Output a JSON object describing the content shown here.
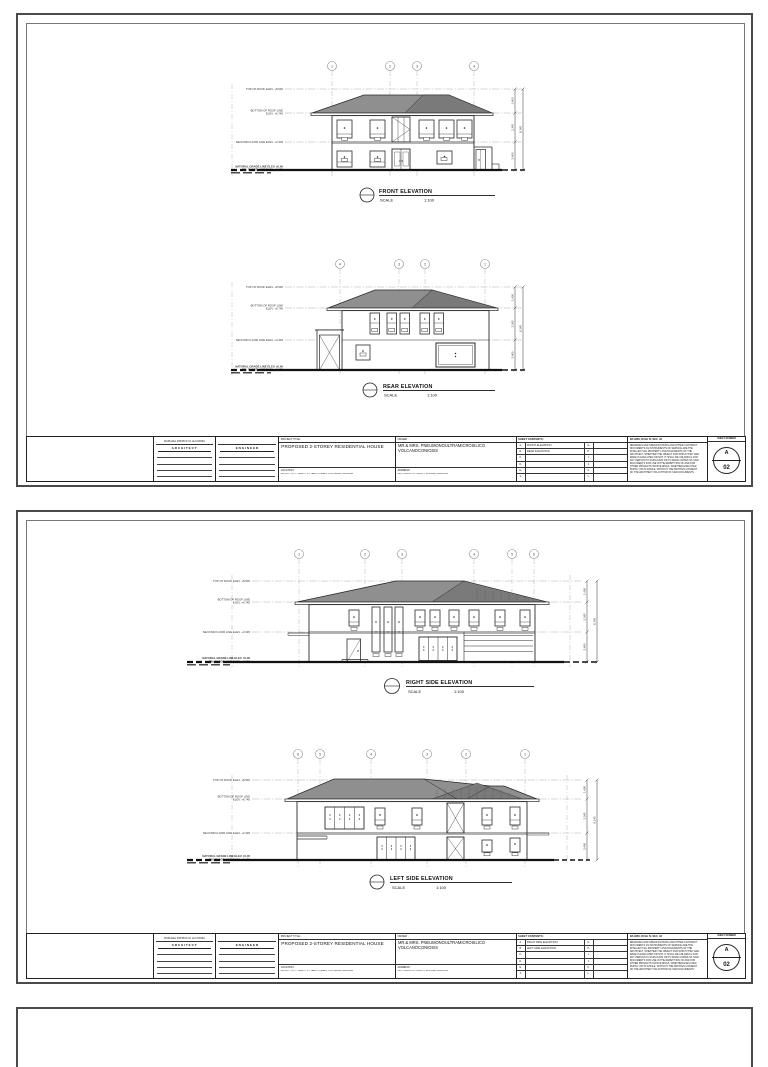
{
  "page": {
    "background": "#ffffff",
    "line_color": "#2b2b2b",
    "roof_fill": "#8f8f8f",
    "roof_fill_dark": "#7a7a7a",
    "border_color": "#4a4a4a"
  },
  "views": [
    {
      "label": "FRONT ELEVATION",
      "scale_label": "SCALE",
      "scale": "1:100",
      "bubbles": [
        "1",
        "2",
        "3",
        "4"
      ],
      "levels": [
        [
          "TOP OF ROOF ELEV. +8.545",
          ""
        ],
        [
          "BOTTOM OF ROOF LINE",
          "ELEV. +6.745"
        ],
        [
          "SECOND FLOOR LINE ELEV. +3.345",
          ""
        ],
        [
          "NATURAL GRADE LINE ELEV. ±0.00",
          "FIN. FLOOR LINE ELEV. +0.150"
        ]
      ],
      "dims": [
        "1,400",
        "3,345",
        "3,400"
      ],
      "dim_total": "8,145"
    },
    {
      "label": "REAR ELEVATION",
      "scale_label": "SCALE",
      "scale": "1:100",
      "bubbles": [
        "4",
        "3",
        "2",
        "1"
      ],
      "levels": [
        [
          "TOP OF ROOF ELEV. +8.545",
          ""
        ],
        [
          "BOTTOM OF ROOF LINE",
          "ELEV. +6.745"
        ],
        [
          "SECOND FLOOR LINE ELEV. +3.345",
          ""
        ],
        [
          "NATURAL GRADE LINE ELEV. ±0.00",
          "FIN. FLOOR LINE ELEV. +0.150"
        ]
      ],
      "dims": [
        "1,400",
        "3,345",
        "3,400"
      ],
      "dim_total": "8,145"
    },
    {
      "label": "RIGHT SIDE ELEVATION",
      "scale_label": "SCALE",
      "scale": "1:100",
      "bubbles": [
        "1",
        "2",
        "3",
        "4",
        "5",
        "6"
      ],
      "levels": [
        [
          "TOP OF ROOF ELEV. +8.545",
          ""
        ],
        [
          "BOTTOM OF ROOF LINE",
          "ELEV. +6.745"
        ],
        [
          "SECOND FLOOR LINE ELEV. +3.345",
          ""
        ],
        [
          "NATURAL GRADE LINE ELEV. ±0.00",
          "FIN. FLOOR LINE ELEV. +0.150"
        ]
      ],
      "dims": [
        "1,400",
        "3,345",
        "3,400"
      ],
      "dim_total": "8,145"
    },
    {
      "label": "LEFT SIDE ELEVATION",
      "scale_label": "SCALE",
      "scale": "1:100",
      "bubbles": [
        "6",
        "5",
        "4",
        "3",
        "2",
        "1"
      ],
      "levels": [
        [
          "TOP OF ROOF ELEV. +8.545",
          ""
        ],
        [
          "BOTTOM OF ROOF LINE",
          "ELEV. +6.745"
        ],
        [
          "SECOND FLOOR LINE ELEV. +3.345",
          ""
        ],
        [
          "NATURAL GRADE LINE ELEV. ±0.00",
          "FIN. FLOOR LINE ELEV. +0.150"
        ]
      ],
      "dims": [
        "1,400",
        "3,345",
        "3,400"
      ],
      "dim_total": "8,145"
    }
  ],
  "sheets": [
    {
      "title_block": {
        "architect_name": "RAPHAEL PATRICK M. ALCORIZA",
        "architect_label": "ARCHITECT",
        "engineer_label": "ENGINEER",
        "project_title_label": "PROJECT TITLE :",
        "project_title": "PROPOSED 2-STOREY RESIDENTIAL HOUSE",
        "location_label": "LOCATION :",
        "location": "BLOCK 7 LOT 7 EARTH ST. NEPO HOMES, STA. MARIA, BULACAN",
        "owner_label": "OWNER :",
        "owner": "MR.& MRS. PNEUMONOULTRAMICROSILICO VOLCANOCONIOSIS",
        "address_label": "ADDRESS :",
        "address": "140 TUAZON ST. IGULOT, BOCAUE, BULACAN",
        "contents_label": "SHEET CONTENTS :",
        "contents_left_letters": [
          "A.",
          "B.",
          "C.",
          "D.",
          "E.",
          "F."
        ],
        "contents_left_texts": [
          "FRONT ELEVATION",
          "REAR ELEVATION",
          "",
          "",
          "",
          ""
        ],
        "contents_right_letters": [
          "G.",
          "H.",
          "I.",
          "J.",
          "K.",
          "L."
        ],
        "contents_right_texts": [
          "",
          "",
          "",
          "",
          "",
          ""
        ],
        "notes_header": "RA 9266, RULE IV, SEC. 33",
        "notes_lines": [
          "DRAWINGS AND SPECIFICATIONS AND OTHER CONTRACT",
          "DOCUMENTS AS INSTRUMENTS OF SERVICE ARE THE",
          "INTELLECTUAL PROPERTY AND DOCUMENTS OF THE",
          "ARCHITECT, WHETHER THE OBJECT FOR WHICH THEY ARE",
          "MADE IS EXECUTED OR NOT. IT SHALL BE UNLAWFUL FOR",
          "ANY PERSON TO DUPLICATE OR TO MAKE COPIES OF SAID",
          "DOCUMENTS FOR USE IN THE REPETITION OF AND FOR",
          "OTHER PROJECTS OR BUILDINGS, WHETHER EXECUTED",
          "PARTLY OR IN WHOLE, WITHOUT THE WRITTEN CONSENT",
          "OF THE ARCHITECT OR AUTHOR OF SAID DOCUMENTS."
        ],
        "sheet_number_label": "SHEET NUMBER",
        "sheet_series": "A",
        "sheet_number": "02"
      }
    },
    {
      "title_block": {
        "architect_name": "RAPHAEL PATRICK M. ALCORIZA",
        "architect_label": "ARCHITECT",
        "engineer_label": "ENGINEER",
        "project_title_label": "PROJECT TITLE :",
        "project_title": "PROPOSED 2-STOREY RESIDENTIAL HOUSE",
        "location_label": "LOCATION :",
        "location": "BLOCK 7 LOT 7 EARTH ST. NEPO HOMES, STA. MARIA, BULACAN",
        "owner_label": "OWNER :",
        "owner": "MR.& MRS. PNEUMONOULTRAMICROSILICO VOLCANOCONIOSIS",
        "address_label": "ADDRESS :",
        "address": "140 TUAZON ST. IGULOT, BOCAUE, BULACAN",
        "contents_label": "SHEET CONTENTS :",
        "contents_left_letters": [
          "A.",
          "B.",
          "C.",
          "D.",
          "E.",
          "F."
        ],
        "contents_left_texts": [
          "RIGHT SIDE ELEVATION",
          "LEFT SIDE ELEVATION",
          "",
          "",
          "",
          ""
        ],
        "contents_right_letters": [
          "G.",
          "H.",
          "I.",
          "J.",
          "K.",
          "L."
        ],
        "contents_right_texts": [
          "",
          "",
          "",
          "",
          "",
          ""
        ],
        "notes_header": "RA 9266, RULE IV, SEC. 33",
        "notes_lines": [
          "DRAWINGS AND SPECIFICATIONS AND OTHER CONTRACT",
          "DOCUMENTS AS INSTRUMENTS OF SERVICE ARE THE",
          "INTELLECTUAL PROPERTY AND DOCUMENTS OF THE",
          "ARCHITECT, WHETHER THE OBJECT FOR WHICH THEY ARE",
          "MADE IS EXECUTED OR NOT. IT SHALL BE UNLAWFUL FOR",
          "ANY PERSON TO DUPLICATE OR TO MAKE COPIES OF SAID",
          "DOCUMENTS FOR USE IN THE REPETITION OF AND FOR",
          "OTHER PROJECTS OR BUILDINGS, WHETHER EXECUTED",
          "PARTLY OR IN WHOLE, WITHOUT THE WRITTEN CONSENT",
          "OF THE ARCHITECT OR AUTHOR OF SAID DOCUMENTS."
        ],
        "sheet_number_label": "SHEET NUMBER",
        "sheet_series": "A",
        "sheet_number": "02"
      }
    }
  ]
}
